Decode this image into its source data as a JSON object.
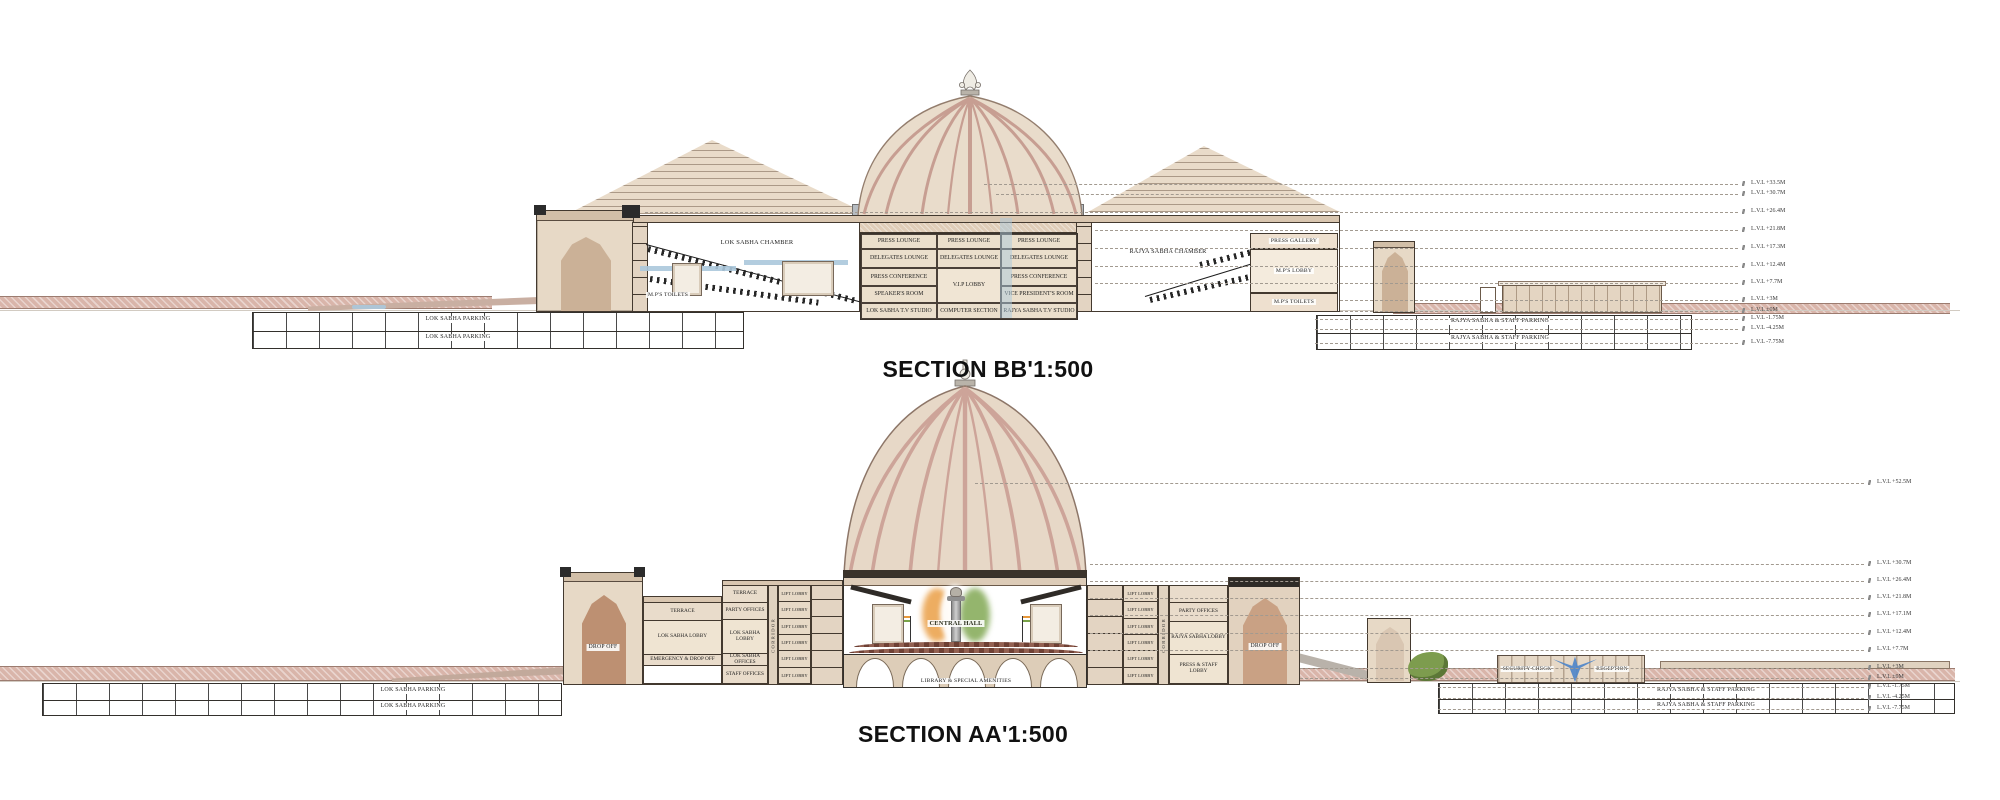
{
  "bb": {
    "title": "SECTION BB'1:500",
    "left": {
      "chamber": "LOK SABHA CHAMBER",
      "toilets": "M.P'S TOILETS"
    },
    "grid": [
      "PRESS LOUNGE",
      "PRESS LOUNGE",
      "PRESS LOUNGE",
      "DELEGATES LOUNGE",
      "DELEGATES LOUNGE",
      "DELEGATES LOUNGE",
      "PRESS CONFERENCE",
      "V.I.P LOBBY",
      "PRESS CONFERENCE",
      "SPEAKER'S ROOM",
      "VICE PRESIDENT'S ROOM",
      "LOK SABHA T.V STUDIO",
      "COMPUTER SECTION",
      "RAJYA SABHA T.V STUDIO"
    ],
    "right": {
      "chamber": "RAJYA SABHA CHAMBER",
      "press_gallery": "PRESS GALLERY",
      "lobby": "M.P'S LOBBY",
      "toilets": "M.P'S TOILETS"
    },
    "parking_left": [
      "LOK SABHA PARKING",
      "LOK SABHA PARKING"
    ],
    "parking_right": [
      "RAJYA SABHA & STAFF PARKING",
      "RAJYA SABHA & STAFF PARKING"
    ],
    "levels": [
      "L.V.L +33.5M",
      "L.V.L +30.7M",
      "L.V.L +26.4M",
      "L.V.L +21.8M",
      "L.V.L +17.3M",
      "L.V.L +12.4M",
      "L.V.L +7.7M",
      "L.V.L +3M",
      "L.V.L ±0M",
      "L.V.L -1.75M",
      "L.V.L -4.25M",
      "L.V.L -7.75M"
    ]
  },
  "aa": {
    "title": "SECTION AA'1:500",
    "center": {
      "hall": "CENTRAL HALL",
      "library": "LIBRARY & SPECIAL AMENITIES"
    },
    "left": {
      "drop_off": "DROP OFF",
      "terrace_a": "TERRACE",
      "terrace_b": "TERRACE",
      "party": "PARTY OFFICES",
      "lobby_a": "LOK SABHA LOBBY",
      "lobby_b": "LOK SABHA LOBBY",
      "emergency": "EMERGENCY & DROP OFF",
      "offices": "LOK SABHA OFFICES",
      "staff": "STAFF OFFICES",
      "corridor": "CORRIDOR",
      "lift": "LIFT LOBBY"
    },
    "right": {
      "party": "PARTY OFFICES",
      "lobby": "RAJYA SABHA LOBBY",
      "press_staff": "PRESS & STAFF LOBBY",
      "corridor": "CORRIDOR",
      "drop_off": "DROP OFF",
      "lift": "LIFT LOBBY"
    },
    "site": {
      "security": "SECURITY CHECK",
      "reception": "RECEPTION"
    },
    "parking_left": [
      "LOK SABHA PARKING",
      "LOK SABHA PARKING"
    ],
    "parking_right": [
      "RAJYA SABHA & STAFF PARKING",
      "RAJYA SABHA & STAFF PARKING"
    ],
    "levels": [
      "L.V.L +52.5M",
      "L.V.L +30.7M",
      "L.V.L +26.4M",
      "L.V.L +21.8M",
      "L.V.L +17.1M",
      "L.V.L +12.4M",
      "L.V.L +7.7M",
      "L.V.L +3M",
      "L.V.L ±0M",
      "L.V.L -1.75M",
      "L.V.L -4.25M",
      "L.V.L -7.75M"
    ]
  },
  "colors": {
    "wall": "#e6d8c6",
    "wall_dark": "#cdb49e",
    "dome_rib": "#c89e92",
    "ground_pink": "#d9b5aa",
    "drum_gray": "#b6bcc2",
    "line_dark": "#43392f",
    "water_blue": "#4f86c9",
    "glass_blue": "#abc8dc",
    "landscape_green": "#7d9c4e",
    "emblem_saffron": "#e8983a",
    "emblem_green": "#79a348"
  }
}
